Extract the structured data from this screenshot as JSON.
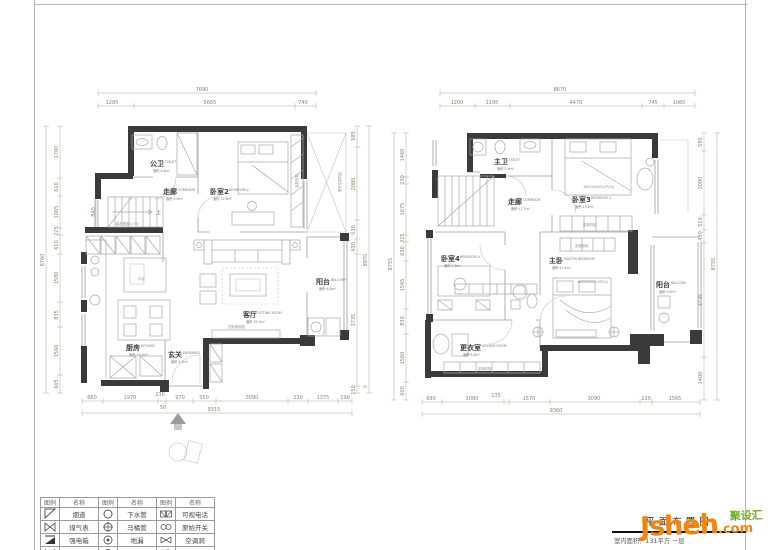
{
  "plans": {
    "left": {
      "rooms": [
        {
          "cn": "公卫",
          "en": "TOILET",
          "area": "面积:4.6m²"
        },
        {
          "cn": "走廊",
          "en": "CORRIDOR",
          "area": "面积:9.0m²"
        },
        {
          "cn": "卧室2",
          "en": "BEDROOM-2",
          "area": "面积:12.6m²"
        },
        {
          "cn": "厨房",
          "en": "KITCHEN",
          "area": "面积:14.5m²"
        },
        {
          "cn": "玄关",
          "en": "ENTRANCE",
          "area": "面积:2.2m²"
        },
        {
          "cn": "客厅",
          "en": "SITTING ROOM",
          "area": "面积:33.0m²"
        },
        {
          "cn": "阳台",
          "en": "BALCONY",
          "area": "面积:6.8m²"
        }
      ],
      "dims": {
        "top_total": "7690",
        "top": [
          "1285",
          "5665",
          "740"
        ],
        "bottom": [
          "660",
          "1970",
          "230",
          "50",
          "970",
          "550",
          "3090",
          "230",
          "1375",
          "190"
        ],
        "bottom_total": "9315",
        "left": [
          "1700",
          "610",
          "1065",
          "225",
          "610",
          "1580",
          "835",
          "1560",
          "605"
        ],
        "left_total": "8760",
        "right": [
          "585",
          "2080",
          "530",
          "430",
          "3735",
          "29",
          "150"
        ],
        "right_total": "8970",
        "stair_width": "840"
      },
      "notes": {
        "up": "上",
        "tread": "踏步宽度(170)",
        "platform": "平台",
        "tv_cabinet": "定制电视柜",
        "ac": "室外空调机位"
      }
    },
    "right": {
      "rooms": [
        {
          "cn": "主卫",
          "en": "TOILET",
          "area": "面积:3.9m²"
        },
        {
          "cn": "走廊",
          "en": "CORRIDOR",
          "area": "面积:11.7m²"
        },
        {
          "cn": "卧室3",
          "en": "BEDROOM-3",
          "area": "面积:13.2m²"
        },
        {
          "cn": "卧室4",
          "en": "BEDROOM-4",
          "area": "面积:7.8m²"
        },
        {
          "cn": "主卧",
          "en": "MASTER BEDROOM",
          "area": "面积:13.4m²"
        },
        {
          "cn": "更衣室",
          "en": "DOCKER ROOM",
          "area": "面积:6.6m²"
        },
        {
          "cn": "阳台",
          "en": "BALCONY",
          "area": "面积:9.8m²"
        }
      ],
      "dims": {
        "top_total": "8670",
        "top": [
          "1200",
          "1195",
          "4470",
          "745",
          "1060"
        ],
        "bottom": [
          "690",
          "2080",
          "135",
          "1570",
          "3090",
          "230",
          "1565"
        ],
        "bottom_total": "9360",
        "left": [
          "1460",
          "230",
          "1675",
          "225",
          "630",
          "1565",
          "830",
          "1560",
          "600"
        ],
        "left_total": "8755",
        "right": [
          "595",
          "2080",
          "510",
          "430",
          "3735",
          "1400"
        ],
        "right_total": "8755"
      },
      "notes": {
        "bed_spec": "1800X2000(2PCS)"
      }
    }
  },
  "shared": {
    "wardrobe": "定制衣柜"
  },
  "legend": {
    "headers": [
      "图例",
      "名称",
      "图例",
      "名称",
      "图例",
      "名称"
    ],
    "rows": [
      {
        "n1": "烟道",
        "n2": "下水管",
        "n3": "可视电话"
      },
      {
        "n1": "煤气表",
        "n2": "马桶管",
        "n3": "原始开关"
      },
      {
        "n1": "强电箱",
        "n2": "地漏",
        "n3": "空调洞"
      },
      {
        "n1": "弱电箱",
        "n2": "排水管",
        "n3": "进水口"
      }
    ]
  },
  "titleblock": {
    "title": "平面布置图",
    "subtitle": "室内面积：131平方 一层"
  },
  "watermark": {
    "cn": "聚设汇",
    "main": "Jsheh",
    "tld": ".com"
  }
}
